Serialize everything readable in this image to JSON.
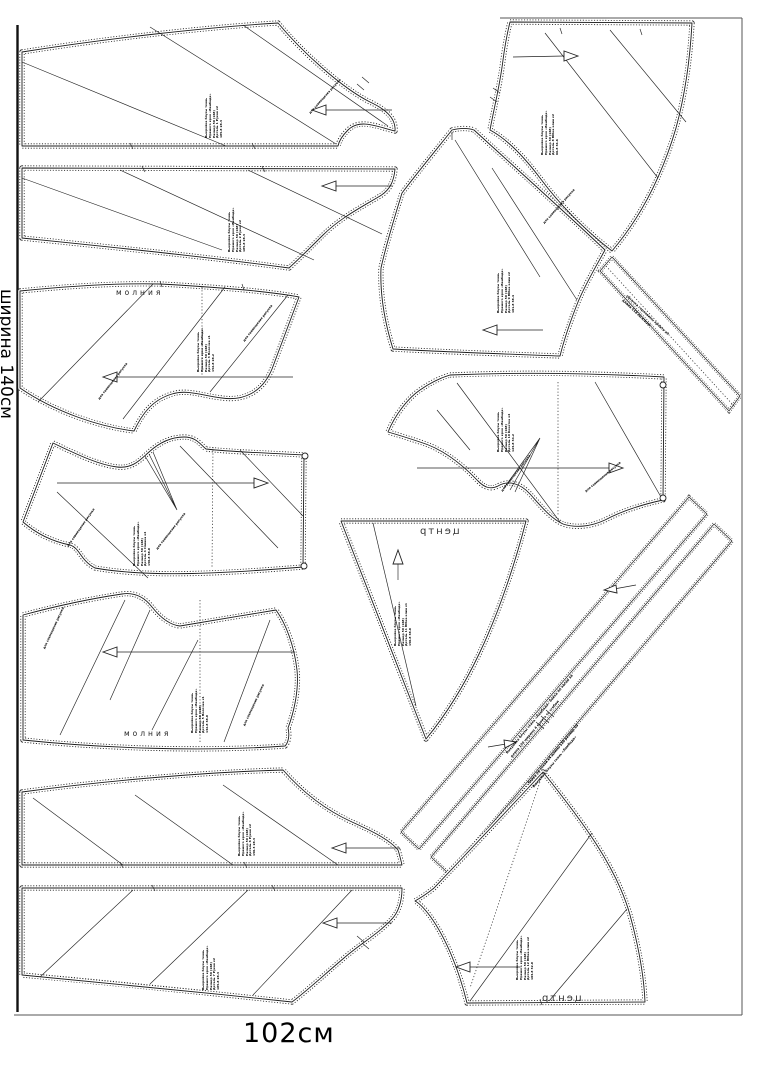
{
  "page": {
    "background": "#ffffff",
    "ink": "#1c1c1c",
    "left_edge_label": "ширина 140см",
    "bottom_label": "102см"
  },
  "labels": {
    "zipper": "молния",
    "center_mirrored": "центр",
    "match_note": "для совмещения рисунка"
  },
  "pieces": {
    "p1": {
      "microtext": "Выкройка блузы ткань\nПрямого кроя «Ламбада»\nРазмер 50 (168)\nДеталь 1  Рукав х2\n185.8   28.3"
    },
    "p2": {
      "microtext": "Выкройка блузы ткань\nПрямого кроя «Ламбада»\nРазмер 50 (168)\nДеталь 2  Рукав х2\n185.8   28.3"
    },
    "p3": {
      "microtext": "Выкройка блузы ткань\nПрямого кроя «Ламбада»\nРазмер 50 (168)\nДеталь 3  Полочка х1\n152.8   28.2"
    },
    "p4": {
      "microtext": "Выкройка блузы ткань\nПрямого кроя «Ламбада»\nРазмер 50 (168)\nДеталь 4  Спинка х2\n150.8   38.8"
    },
    "p5": {
      "microtext": "Выкройка блузы ткань\nПрямого кроя «Ламбада»\nРазмер 50 (168)\nДеталь 5  Полочка х1\n132.8   38.8"
    },
    "p6": {
      "microtext": "Выкройка блузы ткань\nПрямого кроя «Ламбада»\nРазмер 50 (168)\nДеталь 6  Рукав х2\n150.3   28.3"
    },
    "p7": {
      "microtext": "Выкройка блузы ткань\nПрямого кроя «Ламбада»\nРазмер 50 (168)\nДеталь 7  Рукав х2\n185.8   28.3"
    },
    "p8": {
      "microtext": "Выкройка блузы ткань\nПрямого кроя «Ламбада»\nРазмер 50 (168)\nДеталь 8  Юбка клин х2\n66.8   34.6"
    },
    "p9": {
      "microtext": "Выкройка блузы ткань\nПрямого кроя «Ламбада»\nРазмер 50 (168)\nДеталь 9  Юбка клин х2\n101.8   38.4"
    },
    "p11": {
      "microtext": "Выкройка блузы ткань\nПрямого кроя «Ламбада»\nРазмер 50 (168)\nДеталь 10  Кокетка х2\n123.8   34.2"
    },
    "p12": {
      "microtext": "Выкройка блузы ткань\nПрямого кроя «Ламбада»\nРазмер 50 (168)\nДеталь 11  Юбка клин х1\n150.8   38.8"
    },
    "p15": {
      "microtext": "Выкройка блузы ткань\nПрямого кроя «Ламбада»\nРазмер 50 (168)\nДеталь 12  Юбка клин х2\n103.8   32.8"
    },
    "strip10": {
      "microtext": "обтачка горловины  кроить х2\nдлина 118   по косой"
    },
    "stripA": {
      "microtext": "Выкройка блузы ткань «Ламбада»  бейка по косой х4\nдлина 120  ширина 4  кроить со сгибом"
    },
    "stripB": {
      "microtext": "бейка по косой х4  длина 118  размер 50\nВыкройка блузы ткань «Ламбада»"
    }
  }
}
